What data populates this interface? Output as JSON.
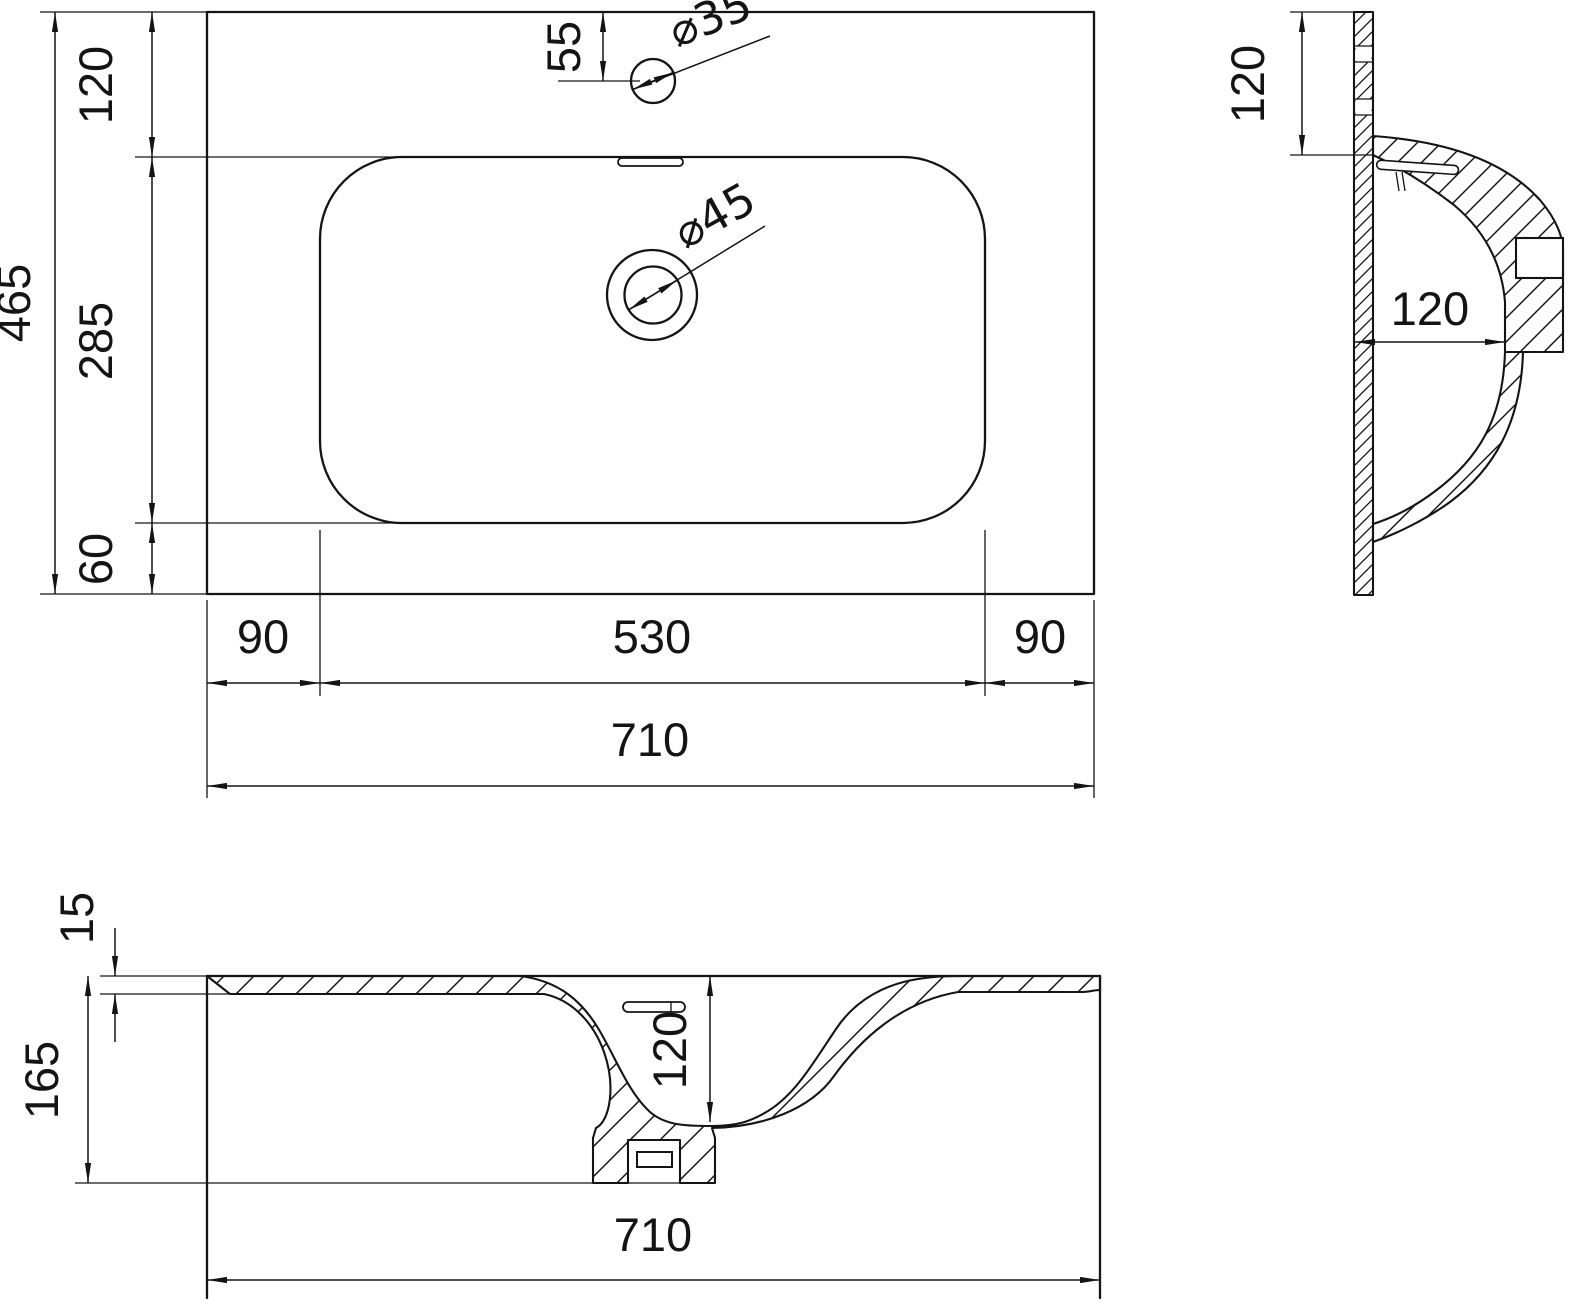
{
  "drawing": {
    "top_view": {
      "dim_total_depth": "465",
      "dim_rim_offset_top": "120",
      "dim_bowl_depth": "285",
      "dim_rim_offset_bottom": "60",
      "dim_faucet_offset": "55",
      "faucet_hole_dia": "⌀35",
      "drain_dia": "⌀45",
      "dim_left_margin": "90",
      "dim_bowl_width": "530",
      "dim_right_margin": "90",
      "dim_total_width": "710"
    },
    "side_view": {
      "dim_rim_height": "120",
      "dim_bowl_inner_depth": "120"
    },
    "front_view": {
      "dim_rim_thickness": "15",
      "dim_total_height": "165",
      "dim_bowl_inner_height": "120",
      "dim_total_width": "710"
    }
  }
}
